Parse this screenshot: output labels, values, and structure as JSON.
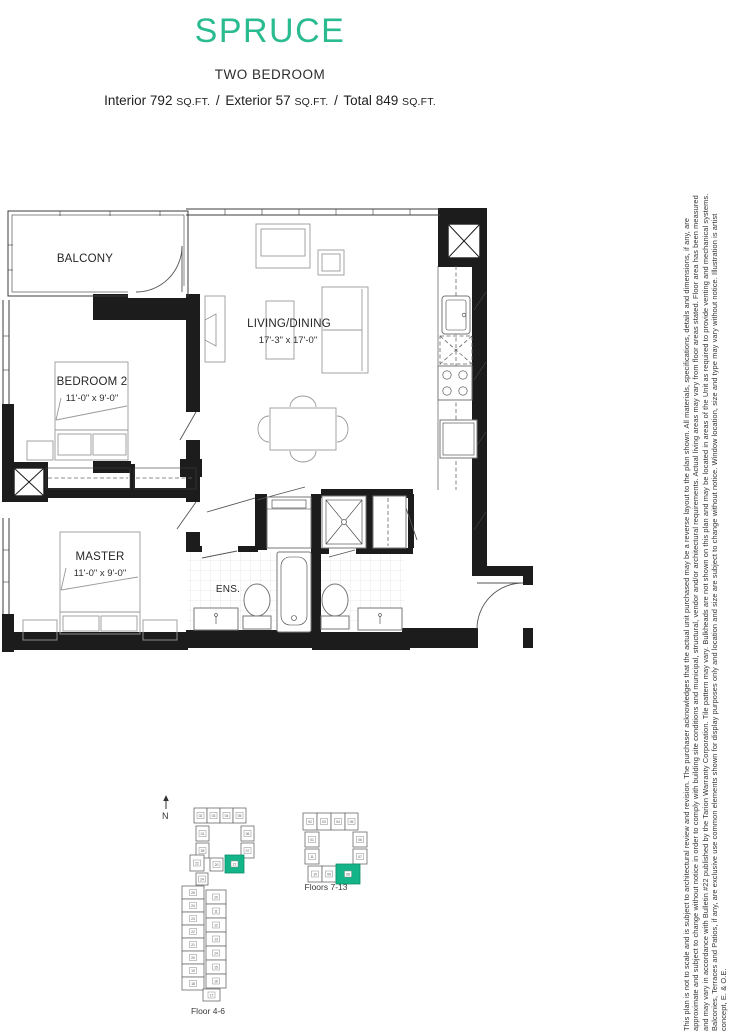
{
  "header": {
    "plan_name": "SPRUCE",
    "plan_type": "TWO BEDROOM",
    "areas": {
      "interior_label": "Interior",
      "interior_value": "792",
      "exterior_label": "Exterior",
      "exterior_value": "57",
      "total_label": "Total",
      "total_value": "849",
      "unit_label": "SQ.FT.",
      "separator": "/"
    }
  },
  "floorplan": {
    "balcony_label": "BALCONY",
    "living_label": "LIVING/DINING",
    "living_dims": "17'-3\" x 17'-0\"",
    "bedroom2_label": "BEDROOM 2",
    "bedroom2_dims": "11'-0\" x 9'-0\"",
    "master_label": "MASTER",
    "master_dims": "11'-0\" x 9'-0\"",
    "ensuite_label": "ENS."
  },
  "keyplans": [
    {
      "label": "Floor 4-6",
      "north_label": "N",
      "units": [
        {
          "x": 36,
          "y": 15,
          "w": 13,
          "h": 15,
          "n": "02"
        },
        {
          "x": 49,
          "y": 15,
          "w": 13,
          "h": 15,
          "n": "03"
        },
        {
          "x": 62,
          "y": 15,
          "w": 13,
          "h": 15,
          "n": "04"
        },
        {
          "x": 75,
          "y": 15,
          "w": 13,
          "h": 15,
          "n": "05"
        },
        {
          "x": 38,
          "y": 33,
          "w": 13,
          "h": 15,
          "n": "01"
        },
        {
          "x": 83,
          "y": 33,
          "w": 13,
          "h": 15,
          "n": "06"
        },
        {
          "x": 38,
          "y": 50,
          "w": 13,
          "h": 15,
          "n": "28"
        },
        {
          "x": 83,
          "y": 50,
          "w": 13,
          "h": 15,
          "n": "07"
        },
        {
          "x": 32,
          "y": 62,
          "w": 14,
          "h": 16,
          "n": "22"
        },
        {
          "x": 52,
          "y": 65,
          "w": 13,
          "h": 13,
          "n": "20"
        },
        {
          "x": 67,
          "y": 62,
          "w": 19,
          "h": 18,
          "n": "21",
          "hl": true
        },
        {
          "x": 38,
          "y": 80,
          "w": 12,
          "h": 12,
          "n": "24"
        },
        {
          "x": 24,
          "y": 93,
          "w": 22,
          "h": 13,
          "n": "25"
        },
        {
          "x": 24,
          "y": 106,
          "w": 22,
          "h": 13,
          "n": "24"
        },
        {
          "x": 24,
          "y": 119,
          "w": 22,
          "h": 13,
          "n": "23"
        },
        {
          "x": 24,
          "y": 132,
          "w": 22,
          "h": 13,
          "n": "22"
        },
        {
          "x": 24,
          "y": 145,
          "w": 22,
          "h": 13,
          "n": "21"
        },
        {
          "x": 24,
          "y": 158,
          "w": 22,
          "h": 13,
          "n": "20"
        },
        {
          "x": 24,
          "y": 171,
          "w": 22,
          "h": 13,
          "n": "19"
        },
        {
          "x": 24,
          "y": 184,
          "w": 22,
          "h": 13,
          "n": "18"
        },
        {
          "x": 48,
          "y": 97,
          "w": 20,
          "h": 14,
          "n": "10"
        },
        {
          "x": 48,
          "y": 111,
          "w": 20,
          "h": 14,
          "n": "11"
        },
        {
          "x": 48,
          "y": 125,
          "w": 20,
          "h": 14,
          "n": "12"
        },
        {
          "x": 48,
          "y": 139,
          "w": 20,
          "h": 14,
          "n": "13"
        },
        {
          "x": 48,
          "y": 153,
          "w": 20,
          "h": 14,
          "n": "14"
        },
        {
          "x": 48,
          "y": 167,
          "w": 20,
          "h": 14,
          "n": "15"
        },
        {
          "x": 48,
          "y": 181,
          "w": 20,
          "h": 14,
          "n": "16"
        },
        {
          "x": 45,
          "y": 196,
          "w": 17,
          "h": 12,
          "n": "17"
        }
      ]
    },
    {
      "label": "Floors 7-13",
      "units": [
        {
          "x": 20,
          "y": 5,
          "w": 14,
          "h": 17,
          "n": "02"
        },
        {
          "x": 34,
          "y": 5,
          "w": 14,
          "h": 17,
          "n": "03"
        },
        {
          "x": 48,
          "y": 5,
          "w": 14,
          "h": 17,
          "n": "04"
        },
        {
          "x": 62,
          "y": 5,
          "w": 13,
          "h": 17,
          "n": "05"
        },
        {
          "x": 22,
          "y": 24,
          "w": 14,
          "h": 15,
          "n": "01"
        },
        {
          "x": 70,
          "y": 24,
          "w": 14,
          "h": 15,
          "n": "06"
        },
        {
          "x": 22,
          "y": 41,
          "w": 14,
          "h": 15,
          "n": "11"
        },
        {
          "x": 70,
          "y": 41,
          "w": 14,
          "h": 15,
          "n": "07"
        },
        {
          "x": 25,
          "y": 58,
          "w": 14,
          "h": 16,
          "n": "10"
        },
        {
          "x": 39,
          "y": 58,
          "w": 14,
          "h": 16,
          "n": "09"
        },
        {
          "x": 53,
          "y": 56,
          "w": 24,
          "h": 20,
          "n": "08",
          "hl": true
        }
      ]
    }
  ],
  "colors": {
    "accent": "#2abb90",
    "highlight": "#12b488",
    "wall": "#1c1c1c"
  },
  "disclaimer": "This plan is not to scale and is subject to architectural review and revision. The purchaser acknowledges that the actual unit purchased may be a reverse layout to the plan shown. All materials, specifications, details and dimensions, if any, are approximate and subject to change without notice in order to comply with building site conditions and municipal, structural, vendor and/or architectural requirements. Actual living areas may vary from floor areas stated. Floor area has been measured and may vary in accordance with Bulletin #22 published by the Tarion Warranty Corporation. Tile pattern may vary. Bulkheads are not shown on this plan and may be located in areas of the Unit as required to provide venting and mechanical systems. Balconies, Terraces and Patios, if any, are exclusive use common elements shown for display purposes only and location and size are subject to change without notice. Window location, size and type may vary without notice. Illustration is artist concept, E. & O.E."
}
